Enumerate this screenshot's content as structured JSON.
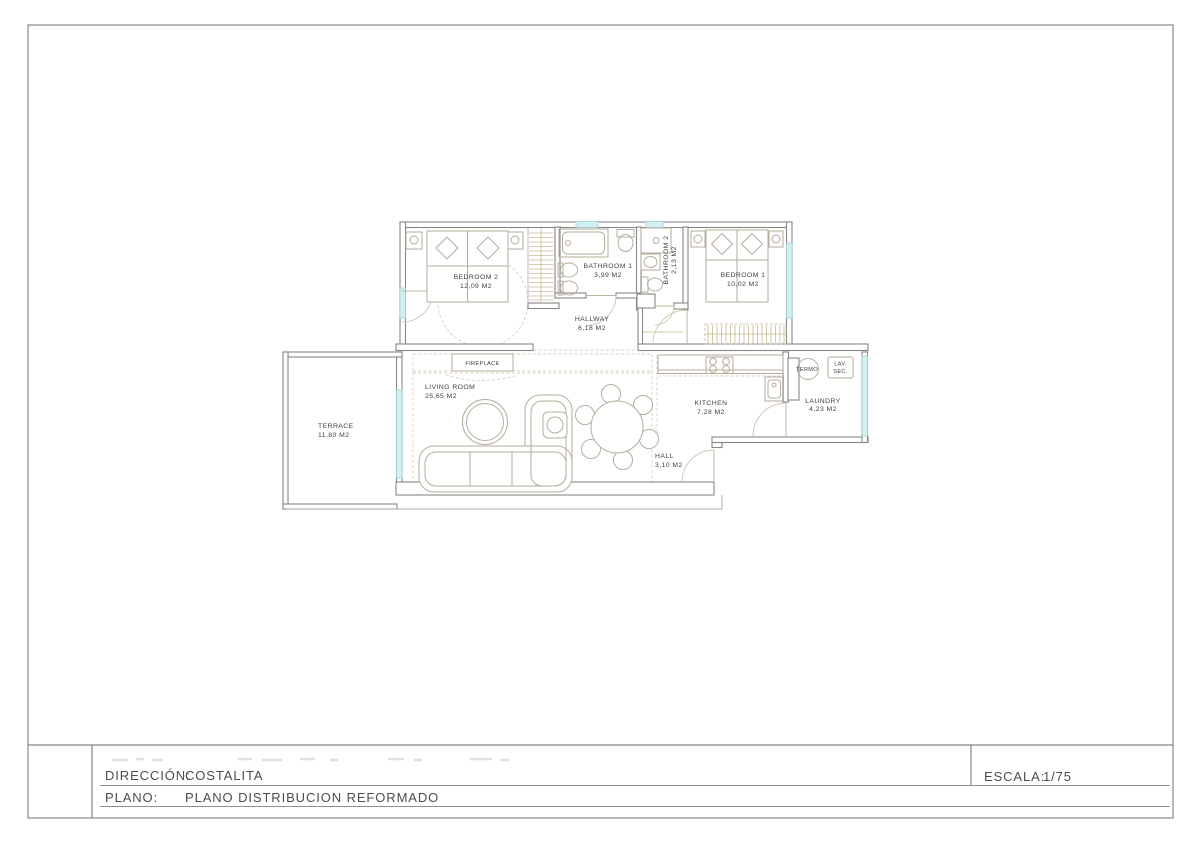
{
  "title_block": {
    "direccion_label": "DIRECCIÓN:",
    "direccion_value": "COSTALITA",
    "plano_label": "PLANO:",
    "plano_value": "PLANO DISTRIBUCION REFORMADO",
    "escala_label": "ESCALA:",
    "escala_value": "1/75"
  },
  "floorplan": {
    "rooms": [
      {
        "id": "bedroom-2",
        "name": "BEDROOM 2",
        "area": "12,09 M2"
      },
      {
        "id": "bathroom-1",
        "name": "BATHROOM 1",
        "area": "3,99 M2"
      },
      {
        "id": "bathroom-2",
        "name": "BATHROOM 2",
        "area": "2,13 M2"
      },
      {
        "id": "bedroom-1",
        "name": "BEDROOM 1",
        "area": "10,02 M2"
      },
      {
        "id": "hallway",
        "name": "HALLWAY",
        "area": "6,18 M2"
      },
      {
        "id": "living-room",
        "name": "LIVING ROOM",
        "area": "25,65 M2"
      },
      {
        "id": "terrace",
        "name": "TERRACE",
        "area": "11,80 M2"
      },
      {
        "id": "kitchen",
        "name": "KITCHEN",
        "area": "7,28 M2"
      },
      {
        "id": "laundry",
        "name": "LAUNDRY",
        "area": "4,23 M2"
      },
      {
        "id": "hall",
        "name": "HALL",
        "area": "3,10 M2"
      }
    ],
    "features": {
      "fireplace": "FIREPLACE",
      "termo": "TERMO",
      "lav": "LAV.",
      "sec": "SEC."
    }
  },
  "colors": {
    "wall": "#878787",
    "furniture": "#b6ae9c",
    "accent_tan": "#c9ba92",
    "window_fill": "#d4eff2",
    "window_stroke": "#9fd3d8",
    "plan_text": "#3f3f3f",
    "title_text": "#4c4c4c"
  }
}
